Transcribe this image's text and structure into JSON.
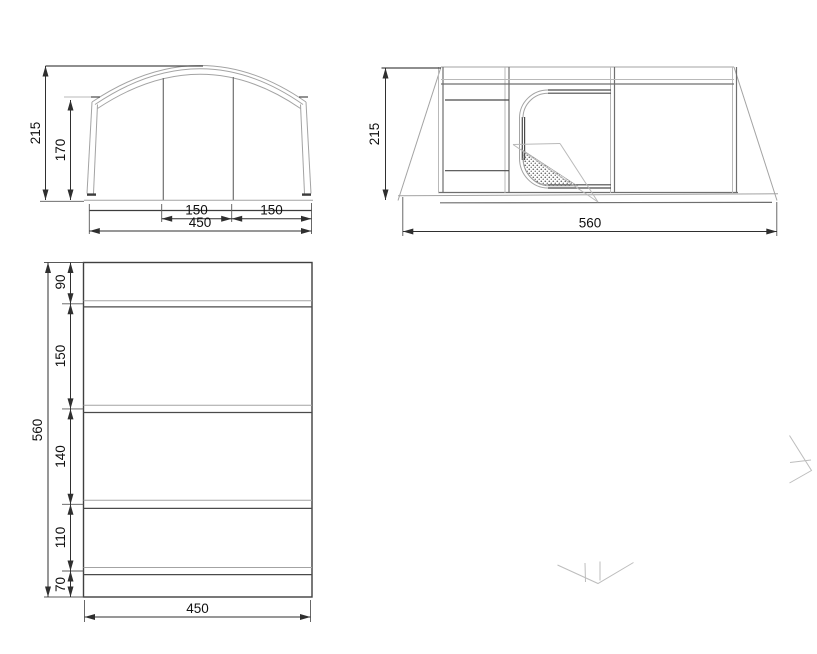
{
  "drawing": {
    "front_view": {
      "title": "front-elevation",
      "dim_height_total": "215",
      "dim_height_wall": "170",
      "dim_door_left": "150",
      "dim_door_right": "150",
      "dim_width_total": "450"
    },
    "side_view": {
      "title": "side-elevation",
      "dim_height_total": "215",
      "dim_length_total": "560"
    },
    "floor_plan": {
      "title": "floor-plan",
      "dim_length_total": "560",
      "dim_width_total": "450",
      "sections": [
        "90",
        "150",
        "140",
        "110",
        "70"
      ]
    }
  }
}
